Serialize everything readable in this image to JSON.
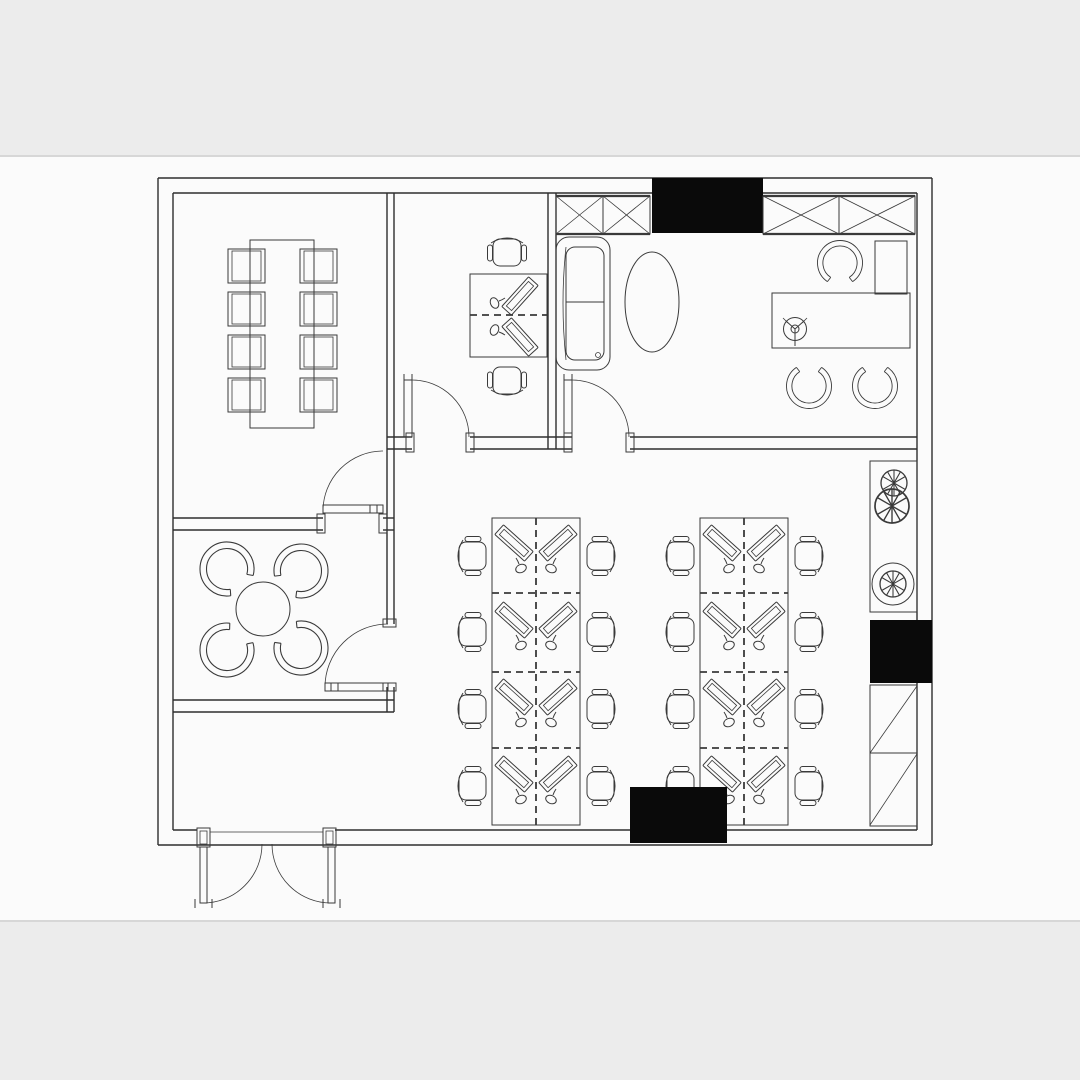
{
  "scene": {
    "kind": "architectural floor plan",
    "style": "black-and-white CAD line drawing, top-down view, no text labels",
    "matte": "light gray bands across the top and bottom of the image"
  },
  "colors": {
    "background": "#fbfbfb",
    "matte-band": "#ececec",
    "band-edge": "#d7d7d7",
    "line": "#3a3a3a",
    "wall": "#2e2e2e",
    "solid-fill": "#0a0a0a"
  },
  "labels": {
    "plan": "office floor plan drawing",
    "conference_room": "conference room with long table and eight chairs",
    "lounge": "lounge with four tub chairs around a round table",
    "small_office": "small office with shared double workstation and two task chairs",
    "executive_office": "executive office with desk, sofa, oval coffee table and shelving",
    "open_office": "open office with two banks of eight workstations",
    "entry": "double entry door at bottom left",
    "right_fixtures": "planter, cabinets and shelving along right wall"
  },
  "inventory": {
    "conference_table": 1,
    "conference_chairs": 8,
    "lounge_round_table": 1,
    "lounge_tub_chairs": 4,
    "small_office_workstations": 2,
    "small_office_task_chairs": 2,
    "executive_desk": 1,
    "executive_chair": 1,
    "executive_guest_chairs": 2,
    "sofa": 1,
    "oval_coffee_table": 1,
    "side_cabinet": 1,
    "x_braced_shelving_units": 2,
    "solid_black_cabinets": 3,
    "open_office_desk_banks": 2,
    "open_office_workstations": 16,
    "open_office_task_chairs": 16,
    "plants": 3,
    "diagonal_shelf_cells": 2,
    "interior_doors": 4,
    "entry_double_doors": 2
  }
}
